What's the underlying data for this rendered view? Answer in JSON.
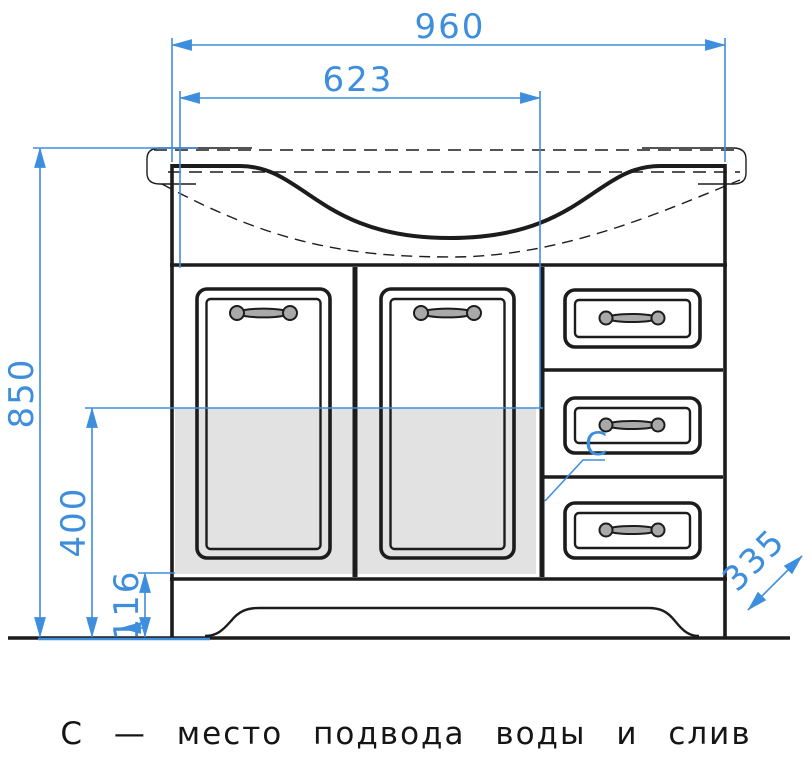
{
  "drawing": {
    "caption": "С — место подвода воды и слив",
    "marker_label": "С",
    "dimensions": {
      "overall_width": "960",
      "basin_width": "623",
      "overall_height": "850",
      "lower_height": "400",
      "plinth_height": "116",
      "depth": "335"
    },
    "colors": {
      "dimension_blue": "#3e8ede",
      "line_black": "#1c1c1c",
      "shade_gray": "#e2e2e2",
      "background": "#ffffff"
    }
  }
}
